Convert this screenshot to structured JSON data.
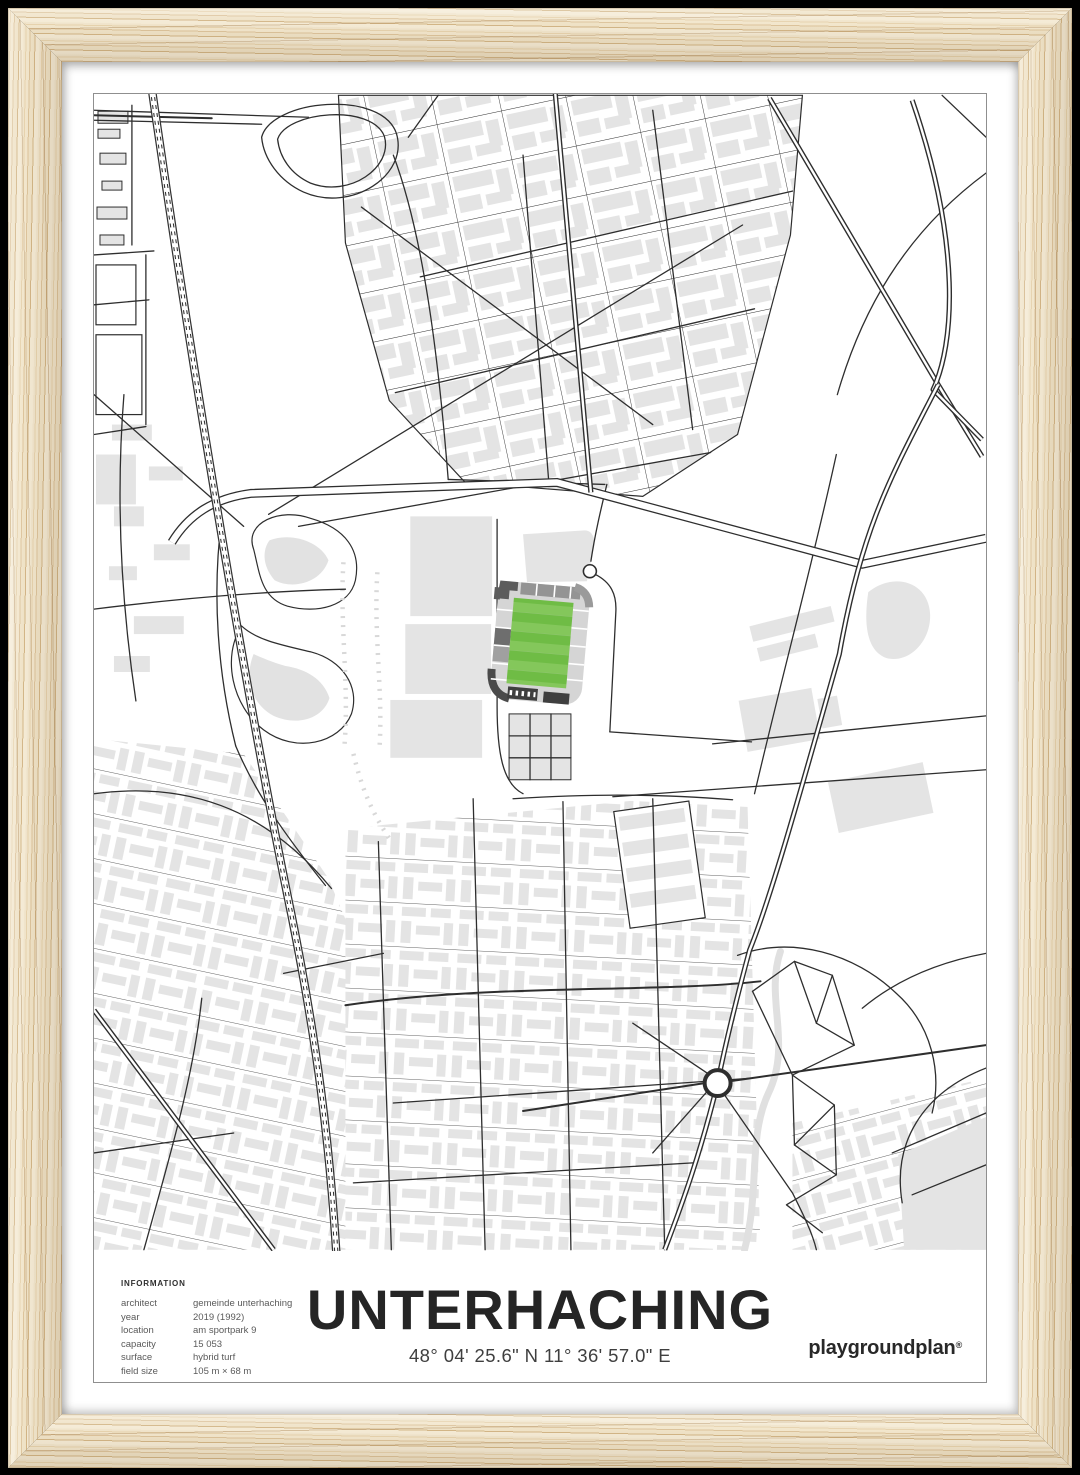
{
  "poster": {
    "title": "UNTERHACHING",
    "coordinates": "48° 04' 25.6\" N 11° 36' 57.0\" E",
    "brand": "playgroundplan",
    "brand_mark": "®",
    "info": {
      "heading": "INFORMATION",
      "rows": [
        {
          "label": "architect",
          "value": "gemeinde unterhaching"
        },
        {
          "label": "year",
          "value": "2019 (1992)"
        },
        {
          "label": "location",
          "value": "am sportpark 9"
        },
        {
          "label": "capacity",
          "value": "15 053"
        },
        {
          "label": "surface",
          "value": "hybrid turf"
        },
        {
          "label": "field size",
          "value": "105 m × 68 m"
        }
      ]
    }
  },
  "colors": {
    "pitch_green_light": "#84c75b",
    "pitch_green_dark": "#6fbc45",
    "building_gray": "#e4e4e4",
    "road_line": "#2e2e2e",
    "wood_light": "#f0e4cb",
    "wood_grain": "#d2b586",
    "mat_white": "#ffffff",
    "backdrop_black": "#000000",
    "stand_light": "#d5d5d5",
    "stand_mid": "#949494",
    "stand_dark": "#5c5c5c",
    "stand_darkest": "#3f3f3f",
    "stream_gray": "#e0e0e0",
    "poster_border": "#8f8f8f"
  }
}
